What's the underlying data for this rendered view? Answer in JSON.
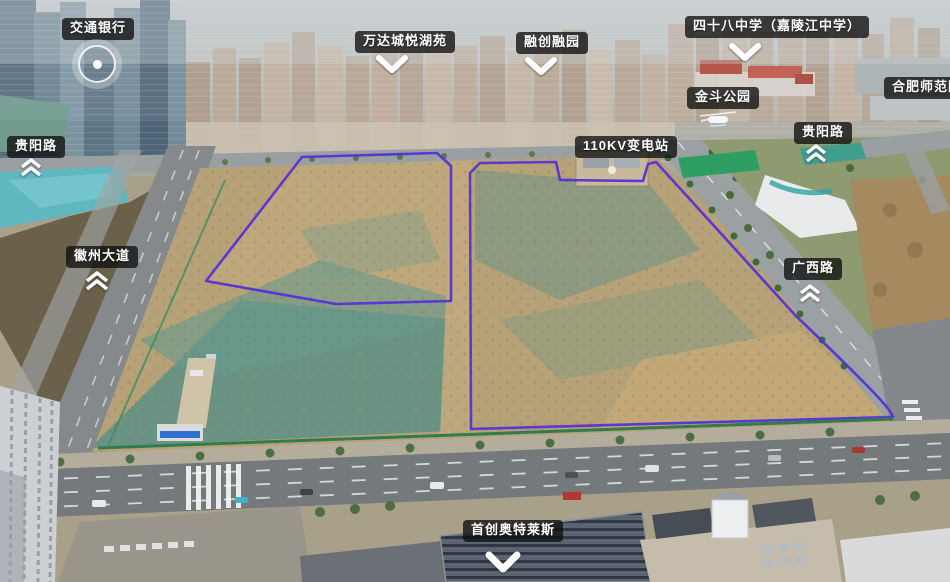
{
  "annotations": {
    "bank": "交通银行",
    "wanda_residence": "万达城悦湖苑",
    "sunac_residence": "融创融园",
    "no48_middle_school": "四十八中学（嘉陵江中学）",
    "hefei_normal_primary": "合肥师范附小",
    "jindou_park": "金斗公园",
    "substation_110kv": "110KV变电站",
    "guiyang_road_left": "贵阳路",
    "guiyang_road_right": "贵阳路",
    "huizhou_avenue": "徽州大道",
    "guangxi_road": "广西路",
    "shouchuang_outlets": "首创奥特莱斯"
  },
  "colors": {
    "parcel_boundary": "#5433d6",
    "construction_fence": "#2f7d4e",
    "label_background": "#101010",
    "label_text": "#ffffff",
    "marker_white": "#ffffff"
  }
}
